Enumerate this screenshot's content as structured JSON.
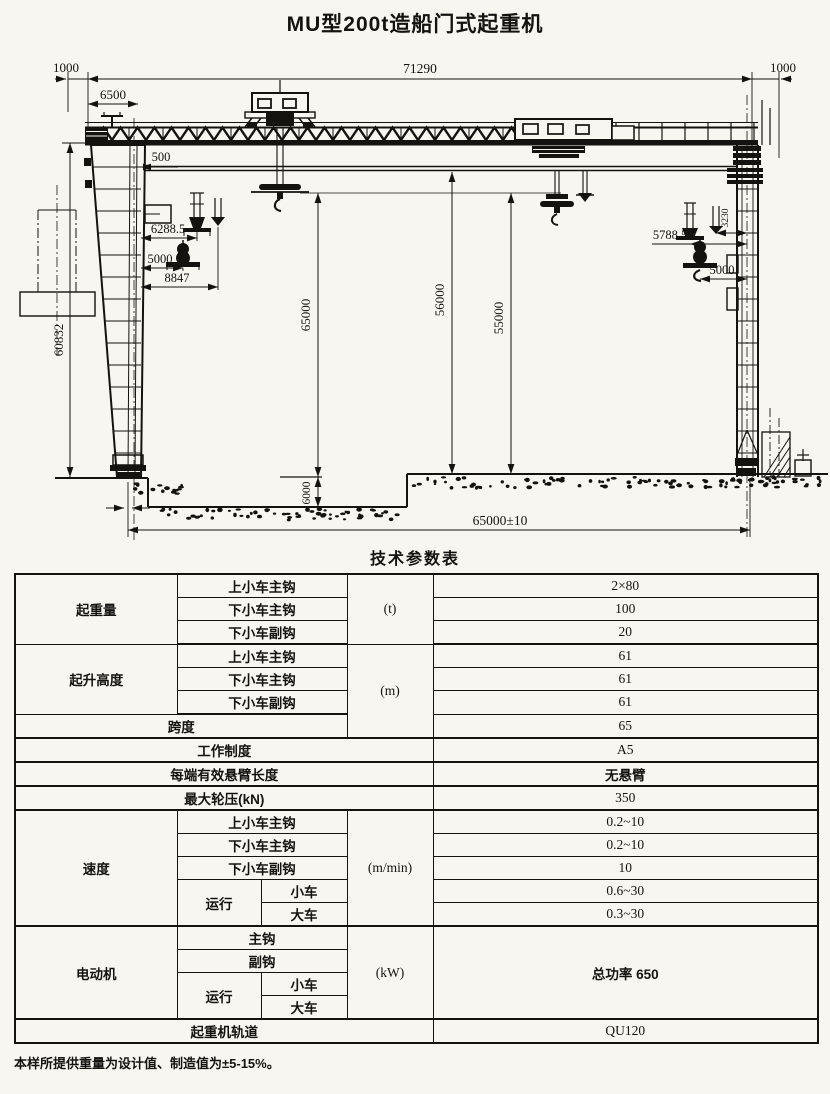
{
  "page": {
    "title": "MU型200t造船门式起重机",
    "footnote": "本样所提供重量为设计值、制造值为±5-15%。"
  },
  "drawing": {
    "dims": {
      "total_length": "71290",
      "overhang_left": "1000",
      "overhang_right": "1000",
      "offset_6500": "6500",
      "offset_500": "500",
      "hook_6288_5": "6288.5",
      "hook_5000_left": "5000",
      "hook_8847": "8847",
      "hook_5788_5": "5788.5",
      "hook_3230": "3230",
      "hook_5000_right": "5000",
      "height_60832": "60832",
      "height_65000": "65000",
      "height_56000": "56000",
      "height_55000": "55000",
      "pit_depth_6000": "6000",
      "rail_span": "65000±10"
    }
  },
  "table": {
    "title": "技术参数表",
    "capacity": {
      "label": "起重量",
      "unit": "(t)",
      "subs": [
        "上小车主钩",
        "下小车主钩",
        "下小车副钩"
      ],
      "values": [
        "2×80",
        "100",
        "20"
      ]
    },
    "hoist_height": {
      "label": "起升高度",
      "unit": "(m)",
      "subs": [
        "上小车主钩",
        "下小车主钩",
        "下小车副钩"
      ],
      "values": [
        "61",
        "61",
        "61"
      ]
    },
    "span": {
      "label": "跨度",
      "value": "65"
    },
    "duty": {
      "label": "工作制度",
      "value": "A5"
    },
    "cantilever": {
      "label": "每端有效悬臂长度",
      "value": "无悬臂"
    },
    "wheel_load": {
      "label": "最大轮压(kN)",
      "value": "350"
    },
    "speed": {
      "label": "速度",
      "unit": "(m/min)",
      "subs": [
        "上小车主钩",
        "下小车主钩",
        "下小车副钩"
      ],
      "values": [
        "0.2~10",
        "0.2~10",
        "10"
      ],
      "travel_label": "运行",
      "travel_subs": [
        "小车",
        "大车"
      ],
      "travel_values": [
        "0.6~30",
        "0.3~30"
      ]
    },
    "motor": {
      "label": "电动机",
      "unit": "(kW)",
      "subs": [
        "主钩",
        "副钩"
      ],
      "travel_label": "运行",
      "travel_subs": [
        "小车",
        "大车"
      ],
      "value": "总功率 650"
    },
    "rail": {
      "label": "起重机轨道",
      "value": "QU120"
    }
  }
}
